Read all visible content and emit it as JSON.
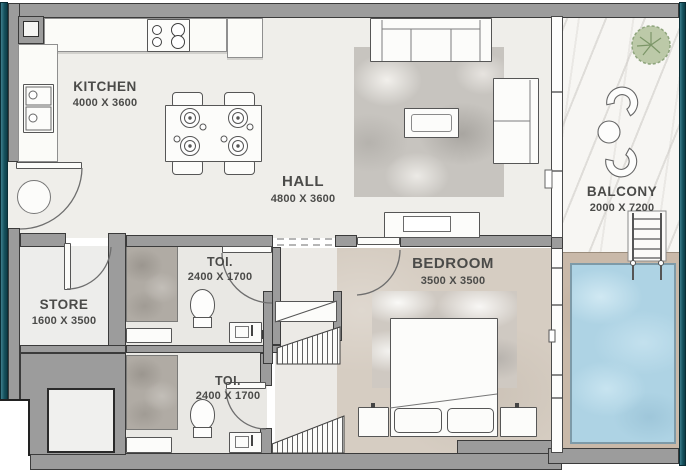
{
  "plan": {
    "rooms": {
      "kitchen": {
        "name": "KITCHEN",
        "dims": "4000 X 3600"
      },
      "hall": {
        "name": "HALL",
        "dims": "4800 X 3600"
      },
      "balcony": {
        "name": "BALCONY",
        "dims": "2000 X 7200"
      },
      "store": {
        "name": "STORE",
        "dims": "1600 X 3500"
      },
      "toilet_top": {
        "name": "TOI.",
        "dims": "2400 X 1700"
      },
      "toilet_bottom": {
        "name": "TOI.",
        "dims": "2400 X 1700"
      },
      "bedroom": {
        "name": "BEDROOM",
        "dims": "3500 X 3500"
      }
    },
    "colors": {
      "wall_fill": "#9c9c9c",
      "wall_outline": "#3b3b3b",
      "edge_teal": "#15525e",
      "floor_main": "#efeeea",
      "floor_bedroom": "#d6cdc2",
      "pool_water": "#aed3e4",
      "pool_deck": "#c9b9a9",
      "balcony_marble": "#f7f6f3",
      "tree_green": "#bcc9a8"
    }
  }
}
